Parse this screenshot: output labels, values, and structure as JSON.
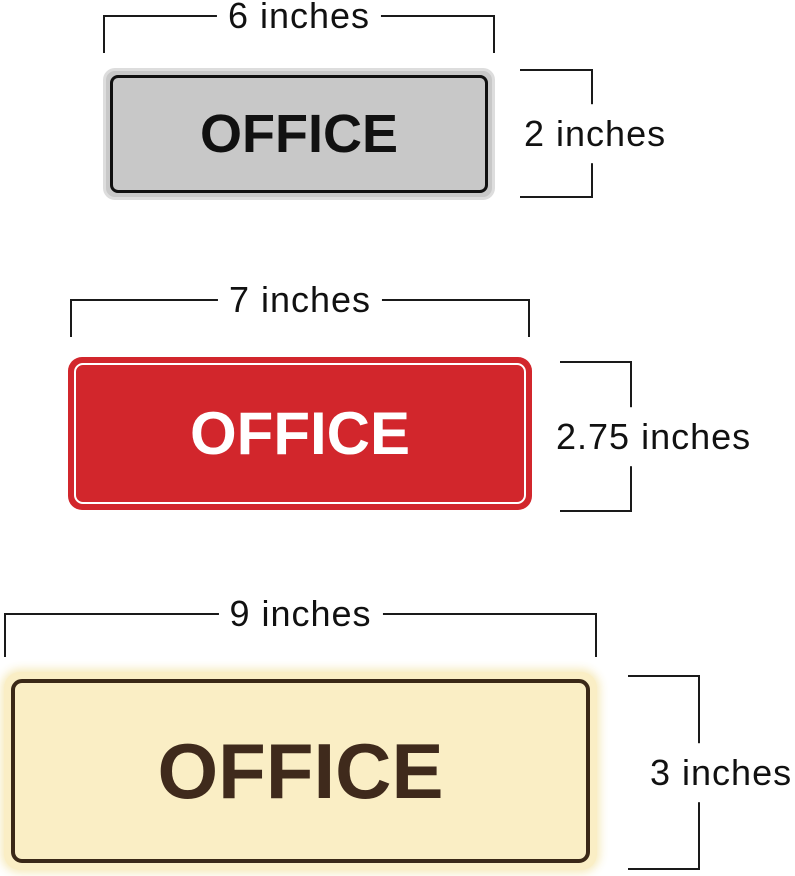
{
  "background": "#ffffff",
  "dimension_line_color": "#1a1a1a",
  "signs": [
    {
      "name": "silver-office-sign",
      "label": "OFFICE",
      "width_label": "6 inches",
      "height_label": "2 inches",
      "colors": {
        "fill": "#c8c8c8",
        "rim": "#dddddd",
        "stroke": "#101010",
        "text": "#111111"
      }
    },
    {
      "name": "red-office-sign",
      "label": "OFFICE",
      "width_label": "7 inches",
      "height_label": "2.75 inches",
      "colors": {
        "fill": "#d2262c",
        "rim": "#d2262c",
        "stroke": "#ffffff",
        "text": "#ffffff"
      }
    },
    {
      "name": "cream-office-sign",
      "label": "OFFICE",
      "width_label": "9 inches",
      "height_label": "3 inches",
      "colors": {
        "fill": "#faeec5",
        "rim": "#f6e9b8",
        "stroke": "#3a2817",
        "text": "#3f2a1c"
      }
    }
  ]
}
